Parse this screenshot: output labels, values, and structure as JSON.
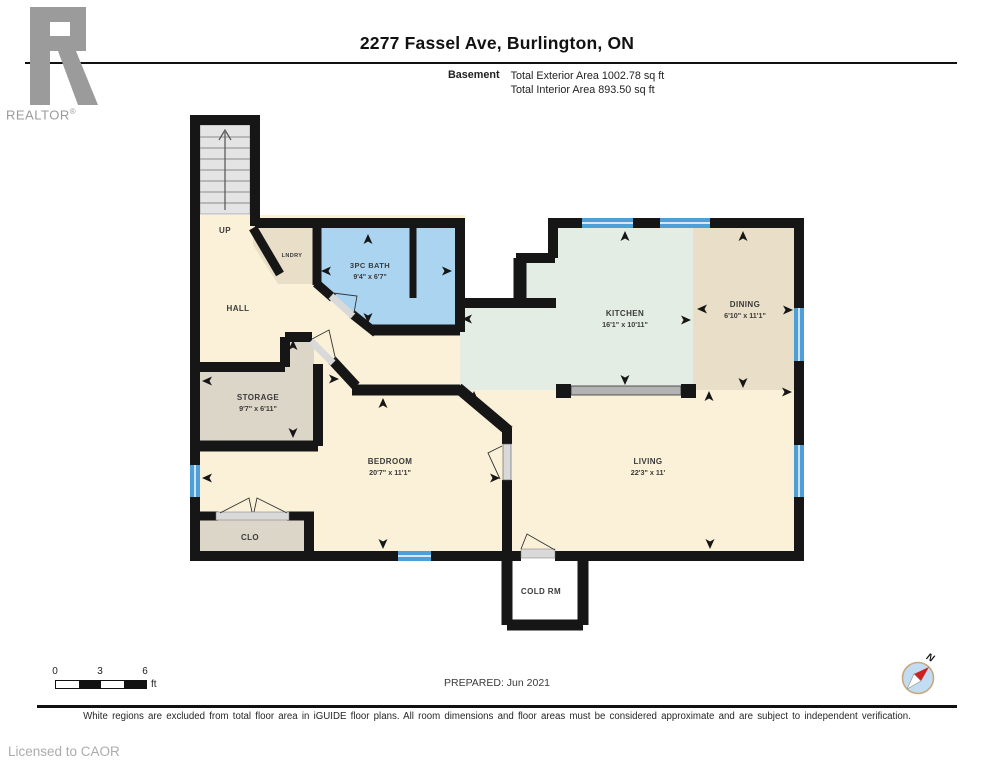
{
  "header": {
    "logo_text": "REALTOR",
    "logo_reg": "®",
    "title": "2277 Fassel Ave, Burlington, ON",
    "floor_label": "Basement",
    "area_line1": "Total Exterior Area 1002.78 sq ft",
    "area_line2": "Total Interior Area 893.50 sq ft"
  },
  "rooms": [
    {
      "id": "up",
      "name": "UP",
      "x": 225,
      "y": 233,
      "size": 8
    },
    {
      "id": "hall",
      "name": "HALL",
      "x": 238,
      "y": 311,
      "size": 8
    },
    {
      "id": "laundry",
      "name": "LNDRY",
      "x": 292,
      "y": 257,
      "size": 5.5
    },
    {
      "id": "bath",
      "name": "3PC BATH",
      "dims": "9'4\" x 6'7\"",
      "x": 370,
      "y": 268,
      "size": 7.5
    },
    {
      "id": "kitchen",
      "name": "KITCHEN",
      "dims": "16'1\" x 10'11\"",
      "x": 625,
      "y": 316,
      "size": 8
    },
    {
      "id": "dining",
      "name": "DINING",
      "dims": "6'10\" x 11'1\"",
      "x": 745,
      "y": 307,
      "size": 8
    },
    {
      "id": "storage",
      "name": "STORAGE",
      "dims": "9'7\" x 6'11\"",
      "x": 258,
      "y": 400,
      "size": 8
    },
    {
      "id": "bedroom",
      "name": "BEDROOM",
      "dims": "20'7\" x 11'1\"",
      "x": 390,
      "y": 464,
      "size": 8
    },
    {
      "id": "living",
      "name": "LIVING",
      "dims": "22'3\" x 11'",
      "x": 648,
      "y": 464,
      "size": 8
    },
    {
      "id": "closet",
      "name": "CLO",
      "x": 250,
      "y": 540,
      "size": 8
    },
    {
      "id": "coldroom",
      "name": "COLD RM",
      "x": 541,
      "y": 594,
      "size": 8
    }
  ],
  "footer": {
    "scale_ticks": [
      "0",
      "3",
      "6"
    ],
    "scale_unit": "ft",
    "prepared": "PREPARED: Jun 2021",
    "disclaimer": "White regions are excluded from total floor area in iGUIDE floor plans. All room dimensions and floor areas must be considered approximate and are subject to independent verification.",
    "licensed": "Licensed to CAOR",
    "compass_north": "N"
  },
  "colors": {
    "wall": "#161616",
    "cream": "#FAF1D8",
    "mint": "#E3EDE4",
    "tan": "#E9DEC8",
    "storage": "#DCD6C8",
    "bath": "#ABD4F0",
    "window": "#4E9FD8",
    "stairs": "#E4E4E4",
    "door": "#D9D9D9",
    "counter": "#B3B3B3",
    "graytext": "#9B9B9B",
    "label": "#3B3B3B"
  }
}
